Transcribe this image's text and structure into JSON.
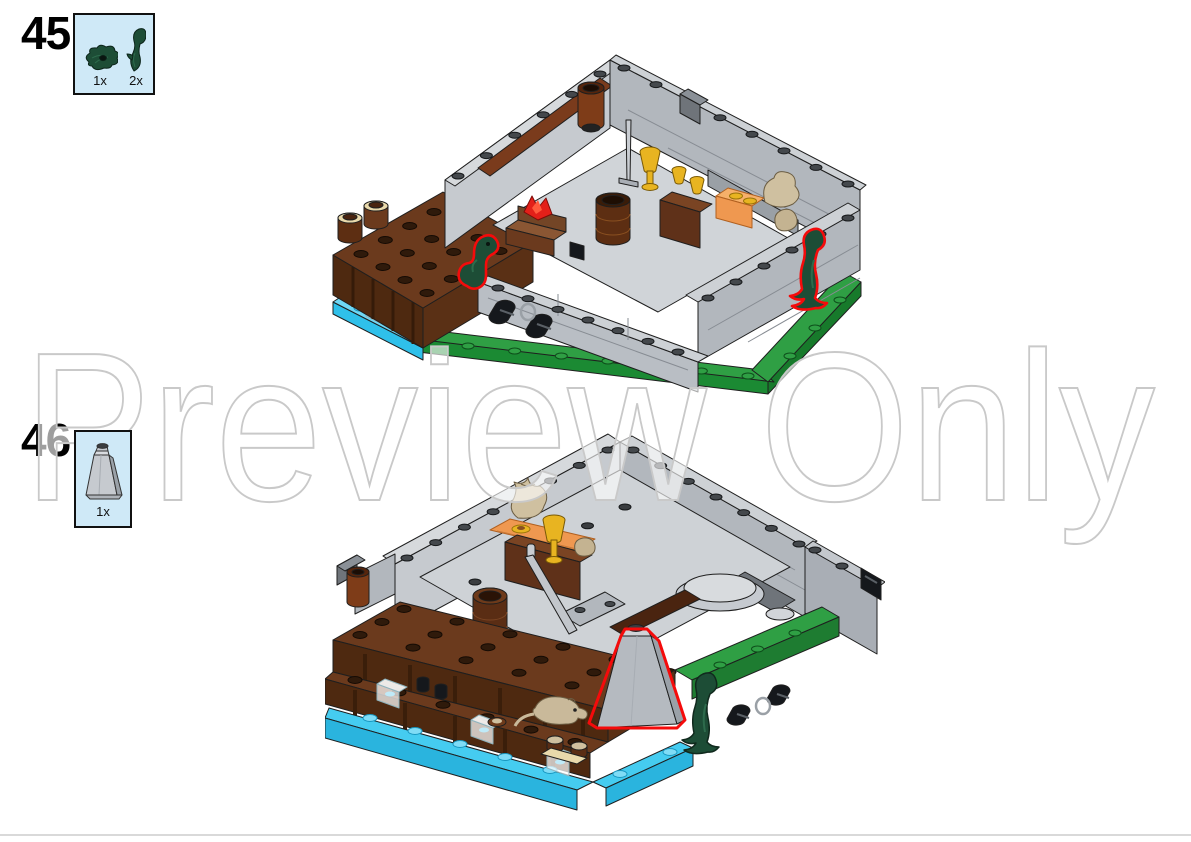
{
  "page": {
    "watermark_text": "Preview Only",
    "background_color": "#ffffff",
    "divider_color": "#d9d9d9",
    "highlight_color": "#f40b0b"
  },
  "steps": [
    {
      "number": "45",
      "parts_box": {
        "fill": "#cfe9f7",
        "border_color": "#111111",
        "parts": [
          {
            "name": "plant-leaves-dark-green",
            "qty": "1x",
            "color": "#1d4d36"
          },
          {
            "name": "vine-branch-dark-green",
            "qty": "2x",
            "color": "#1d4d36"
          }
        ]
      },
      "model": {
        "name": "tavern-cellar-render-step-45",
        "new_parts_highlighted": 2,
        "palette": {
          "wall_gray": "#b2b7bd",
          "floor_brown": "#6b3a1d",
          "water_cyan": "#3cc6ee",
          "baseplate_green": "#2f9f44"
        }
      }
    },
    {
      "number": "46",
      "parts_box": {
        "fill": "#cfe9f7",
        "border_color": "#111111",
        "parts": [
          {
            "name": "rock-cone-light-gray",
            "qty": "1x",
            "color": "#b5bac0"
          }
        ]
      },
      "model": {
        "name": "tavern-cellar-render-step-46",
        "new_parts_highlighted": 1,
        "palette": {
          "wall_gray": "#b2b7bd",
          "floor_brown": "#6b3a1d",
          "water_cyan": "#3cc6ee",
          "baseplate_green": "#2f9f44"
        }
      }
    }
  ]
}
